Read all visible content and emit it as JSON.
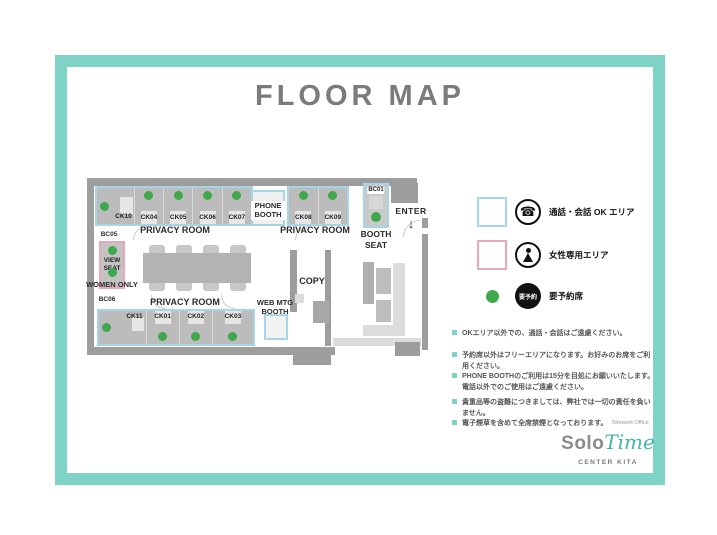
{
  "title": "FLOOR MAP",
  "colors": {
    "frame": "#7fd3c6",
    "call_ok_outline": "#a5d6e8",
    "women_only_outline": "#e9a8b2",
    "reserved_dot": "#3fa84c"
  },
  "floor": {
    "privacy_top_left": {
      "label": "PRIVACY ROOM",
      "rooms": [
        "CK10",
        "CK04",
        "CK05",
        "CK06",
        "CK07"
      ]
    },
    "phone_booth_label": "PHONE BOOTH",
    "privacy_top_right": {
      "label": "PRIVACY ROOM",
      "rooms": [
        "CK08",
        "CK09"
      ]
    },
    "booth_seat": {
      "id": "BC01",
      "label": "BOOTH SEAT"
    },
    "enter": {
      "label": "ENTER",
      "arrow": "↓"
    },
    "bc05": "BC05",
    "view_seat": {
      "label": "VIEW SEAT",
      "area_label": "WOMEN ONLY"
    },
    "bc06": "BC06",
    "privacy_bottom": {
      "label": "PRIVACY ROOM",
      "rooms": [
        "CK11",
        "CK01",
        "CK02",
        "CK03"
      ]
    },
    "web_mtg_booth_label": "WEB MTG BOOTH",
    "copy_label": "COPY"
  },
  "legend": {
    "call_ok": {
      "icon": "phone",
      "label": "通話・会話 OK エリア"
    },
    "women_only": {
      "icon": "female",
      "label": "女性専用エリア"
    },
    "reserved": {
      "badge_text": "要予約",
      "label": "要予約席"
    }
  },
  "notes": [
    {
      "text": "OKエリア以外での、通話・会話はご遠慮ください。"
    },
    {
      "text": "予約席以外はフリーエリアになります。お好みのお席をご利用ください。"
    },
    {
      "text": "PHONE BOOTHのご利用は15分を目処にお願いいたします。",
      "text2": "電話以外でのご使用はご遠慮ください。"
    },
    {
      "text": "貴重品等の盗難につきましては、弊社では一切の責任を負いません。"
    },
    {
      "text": "電子煙草を含めて全席禁煙となっております。"
    }
  ],
  "logo": {
    "office_type": "Telework Office",
    "name_solo": "Solo",
    "name_time": "Time",
    "location": "CENTER KITA"
  }
}
